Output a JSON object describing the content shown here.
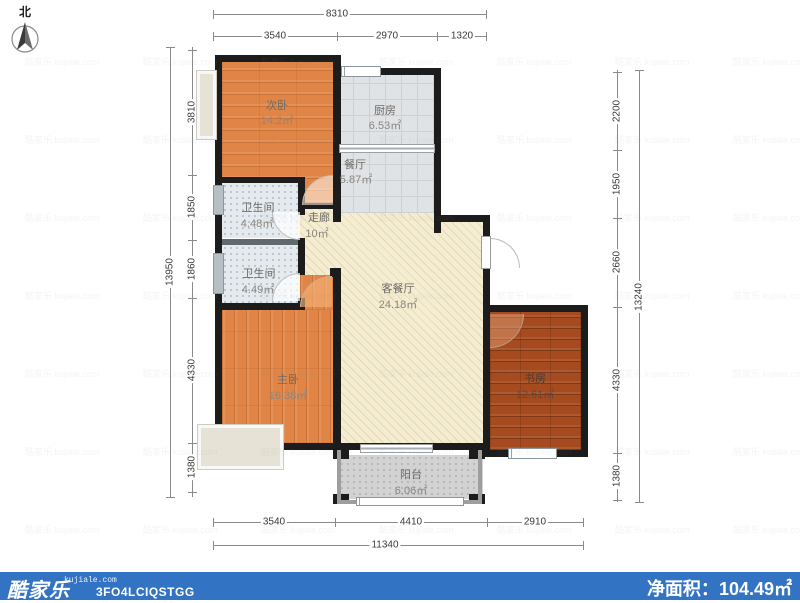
{
  "north_label": "北",
  "watermark": {
    "text": "酷家乐 kujiale.com"
  },
  "colors": {
    "footer_bar": "#3273C4",
    "wall": "#1C1C1C",
    "bedroom_floor": "#E08546",
    "study_floor": "#A64B20",
    "living_floor": "#F5EDD1",
    "tile_floor": "#E0E3E5",
    "bath_floor": "#E4EAED",
    "balcony_floor": "#D2D2D2"
  },
  "rooms": [
    {
      "name": "次卧",
      "area": "14.2㎡"
    },
    {
      "name": "厨房",
      "area": "6.53㎡"
    },
    {
      "name": "餐厅",
      "area": "5.87㎡"
    },
    {
      "name": "卫生间",
      "area": "4.48㎡"
    },
    {
      "name": "走廊",
      "area": "10㎡"
    },
    {
      "name": "卫生间",
      "area": "4.49㎡"
    },
    {
      "name": "主卧",
      "area": "16.38㎡"
    },
    {
      "name": "客餐厅",
      "area": "24.18㎡"
    },
    {
      "name": "书房",
      "area": "12.61㎡"
    },
    {
      "name": "阳台",
      "area": "6.06㎡"
    }
  ],
  "dimensions": {
    "top": {
      "overall": "8310",
      "segments": [
        "3540",
        "2970",
        "1320"
      ]
    },
    "left": {
      "overall": "13950",
      "segments": [
        "3810",
        "1850",
        "1860",
        "4330",
        "1380"
      ]
    },
    "right": {
      "overall": "13240",
      "segments": [
        "2200",
        "1950",
        "2660",
        "4330",
        "1380"
      ]
    },
    "bottom": {
      "overall": "11340",
      "segments": [
        "3540",
        "4410",
        "2910"
      ]
    }
  },
  "footer": {
    "brand": "酷家乐",
    "domain": "kujiale.com",
    "code": "3FO4LCIQSTGG",
    "net_area_label": "净面积：",
    "net_area_value": "104.49㎡"
  }
}
